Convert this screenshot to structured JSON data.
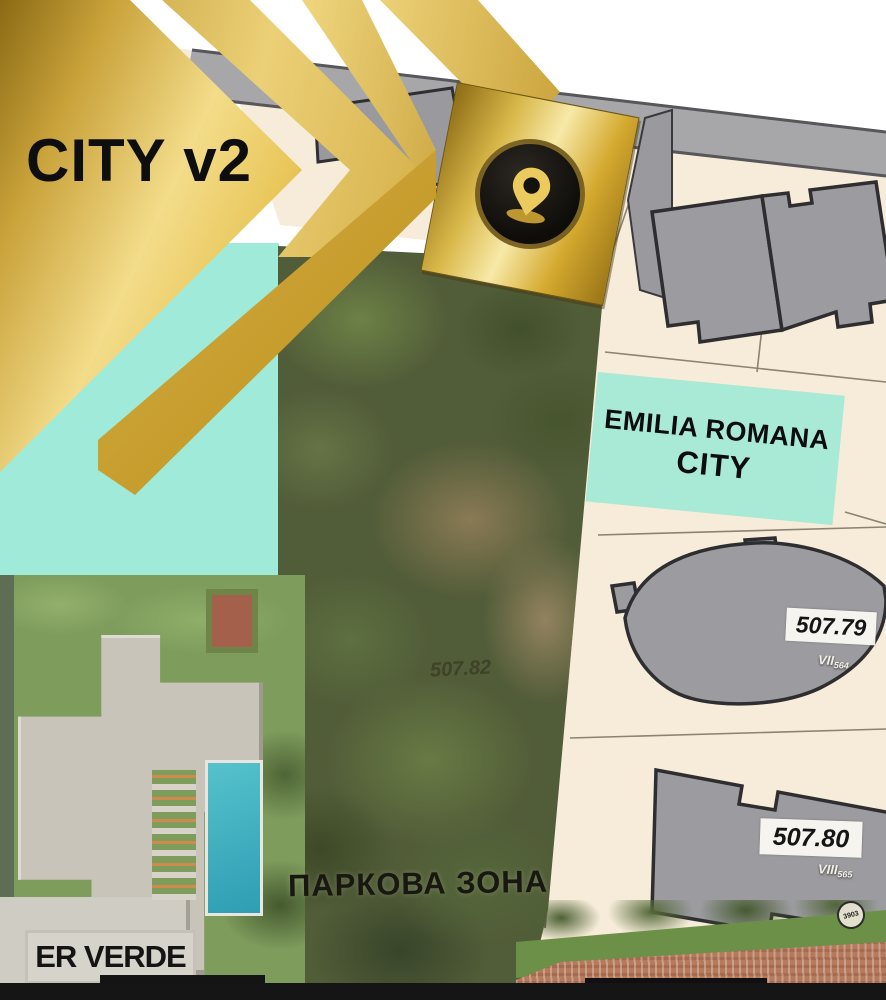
{
  "branding": {
    "arrow_label": "CITY v2"
  },
  "labels": {
    "project_box_line1": "EMILIA ROMANA",
    "project_box_line2": "CITY",
    "park_zone": "ПАРКОВА ЗОНА",
    "er_verde": "ER VERDE",
    "park_elevation": "507.82"
  },
  "parcels": [
    {
      "elevation": "507.79",
      "block_roman": "VII",
      "block_num": "564"
    },
    {
      "elevation": "507.80",
      "block_roman": "VIII",
      "block_num": "565"
    }
  ],
  "stamp": {
    "number": "3903"
  },
  "icons": {
    "pin": "location-pin-icon"
  },
  "colors": {
    "gold": "#d9b545",
    "teal_zone": "#9fead9",
    "project_box_teal": "#a9ead6",
    "cream_parcel": "#f6ecd9",
    "building_gray": "#9c9ca0",
    "road_gray": "#a7a7aa"
  }
}
